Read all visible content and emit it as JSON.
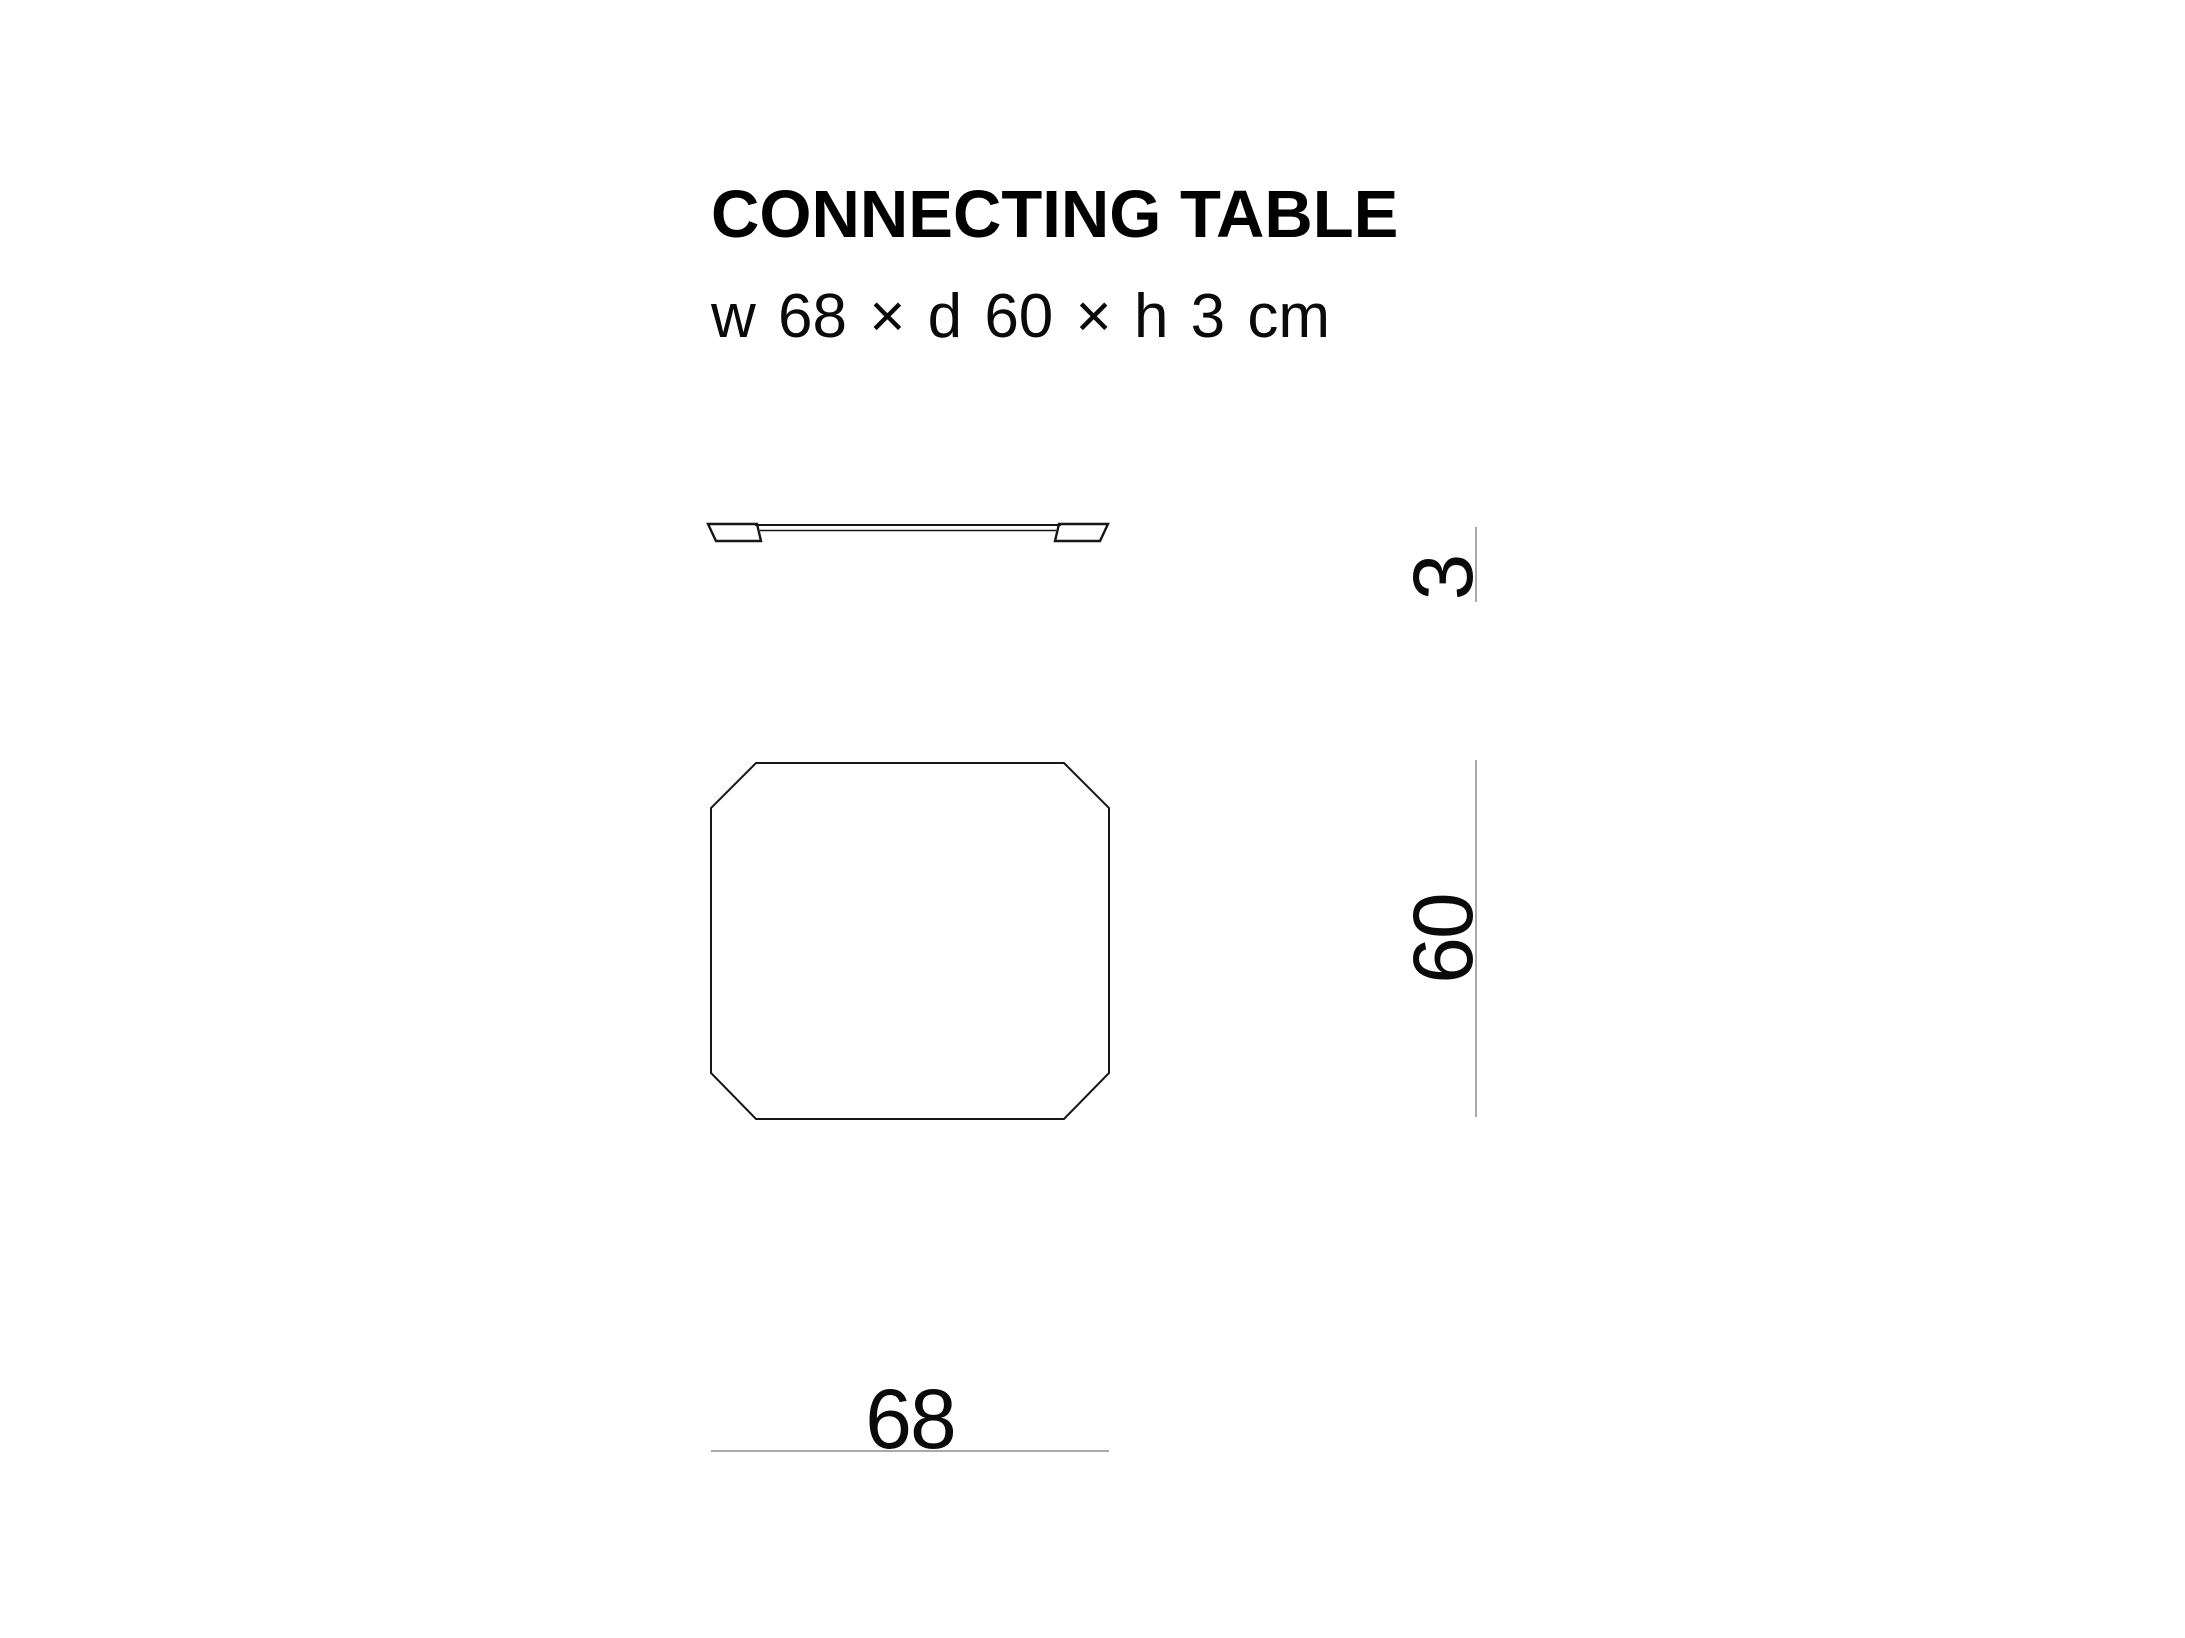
{
  "header": {
    "title": "CONNECTING TABLE",
    "subtitle": "w 68 × d 60 × h 3 cm"
  },
  "dimensions": {
    "width_label": "68",
    "depth_label": "60",
    "height_label": "3",
    "unit": "cm"
  },
  "colors": {
    "background": "#ffffff",
    "drawing_line": "#161616",
    "dimension_line": "#a9a9a9",
    "text": "#000000"
  }
}
